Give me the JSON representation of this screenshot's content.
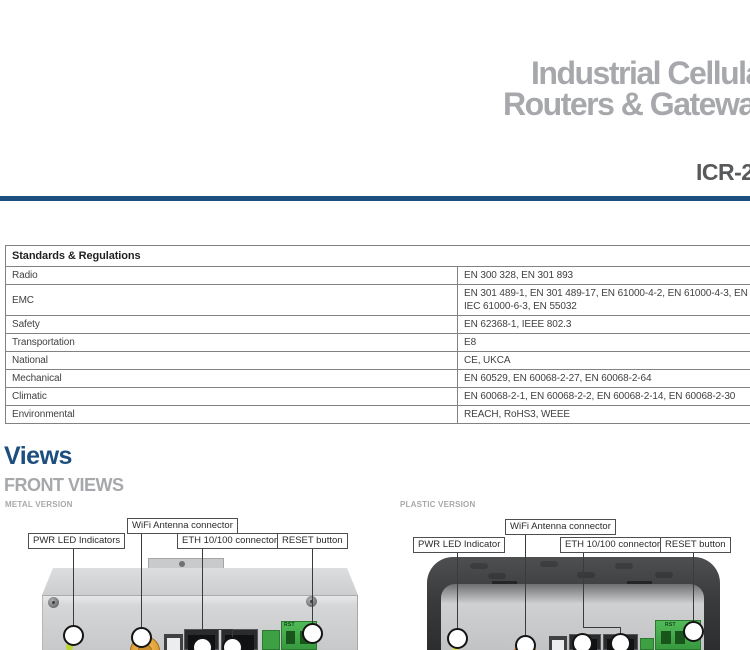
{
  "header": {
    "title_line1": "Industrial Cellular",
    "title_line2": "Routers & Gateways",
    "model": "ICR-27",
    "accent_color": "#1c4e7e",
    "title_color": "#a6a8ab"
  },
  "specs_table": {
    "header": "Standards & Regulations",
    "rows": [
      {
        "label": "Radio",
        "value": "EN 300 328, EN 301 893"
      },
      {
        "label": "EMC",
        "value": "EN 301 489-1, EN 301 489-17, EN 61000-4-2, EN 61000-4-3, EN 61000-4-4, EN 61000-4-5, EN 61000-4-6, EN 61000-4-11, IEC 61000-6-2,\nIEC 61000-6-3, EN 55032"
      },
      {
        "label": "Safety",
        "value": "EN 62368-1, IEEE 802.3"
      },
      {
        "label": "Transportation",
        "value": "E8"
      },
      {
        "label": "National",
        "value": "CE, UKCA"
      },
      {
        "label": "Mechanical",
        "value": "EN 60529, EN 60068-2-27, EN 60068-2-64"
      },
      {
        "label": "Climatic",
        "value": "EN 60068-2-1, EN 60068-2-2, EN 60068-2-14, EN 60068-2-30"
      },
      {
        "label": "Environmental",
        "value": "REACH, RoHS3, WEEE"
      }
    ]
  },
  "views": {
    "section_title": "Views",
    "subsection_title": "FRONT VIEWS",
    "metal": {
      "version_label": "METAL VERSION",
      "callout_pwr": "PWR LED Indicators",
      "callout_wifi": "WiFi Antenna connector",
      "callout_eth": "ETH 10/100 connectors",
      "callout_reset": "RESET button",
      "rst_label": "RST"
    },
    "plastic": {
      "version_label": "PLASTIC VERSION",
      "callout_pwr": "PWR LED Indicator",
      "callout_wifi": "WiFi Antenna connector",
      "callout_eth": "ETH 10/100 connectors",
      "callout_reset": "RESET button",
      "rst_label": "RST"
    }
  },
  "colors": {
    "accent_blue": "#1c4e7e",
    "heading_gray": "#a6a8ab",
    "table_border": "#808285",
    "terminal_green": "#44b04a",
    "antenna_orange": "#e0a03c"
  }
}
